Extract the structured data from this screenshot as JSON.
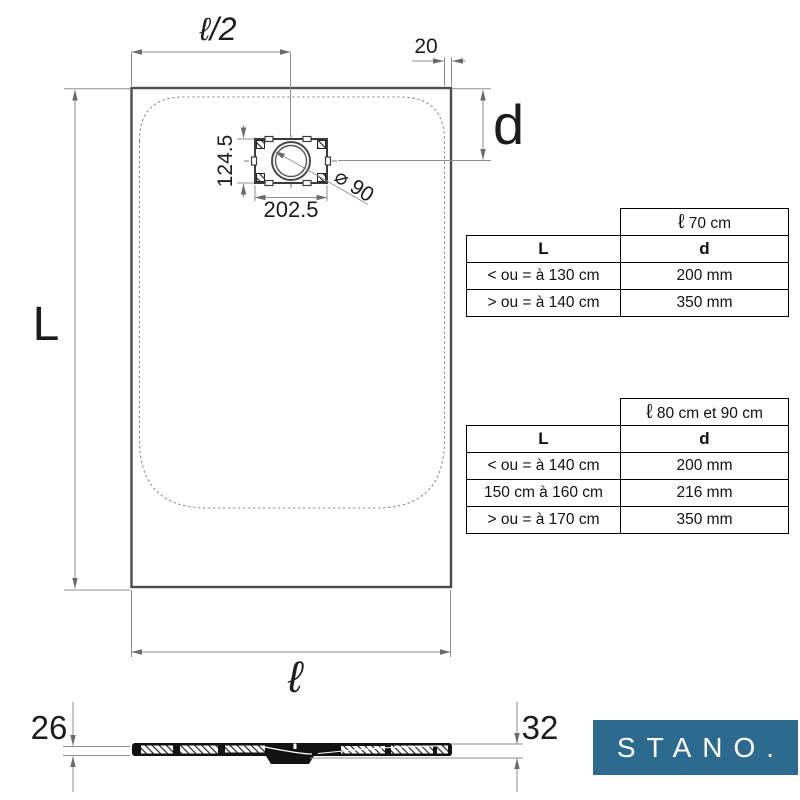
{
  "drawing": {
    "top_view": {
      "half_width_label": "ℓ/2",
      "edge_offset_label": "20",
      "drain_center_depth_label": "d",
      "length_label": "L",
      "drain_box_height_label": "124.5",
      "drain_box_width_label": "202.5",
      "drain_diameter_label": "⌀ 90",
      "width_label": "ℓ"
    },
    "side_view": {
      "thickness_left_label": "26",
      "thickness_right_label": "32"
    }
  },
  "tables": [
    {
      "width_symbol": "ℓ",
      "width_text": "70 cm",
      "col_headers": [
        "L",
        "d"
      ],
      "rows": [
        [
          "< ou = à 130 cm",
          "200 mm"
        ],
        [
          "> ou = à 140 cm",
          "350 mm"
        ]
      ]
    },
    {
      "width_symbol": "ℓ",
      "width_text": "80 cm et 90 cm",
      "col_headers": [
        "L",
        "d"
      ],
      "rows": [
        [
          "< ou = à 140 cm",
          "200 mm"
        ],
        [
          "150 cm à 160 cm",
          "216 mm"
        ],
        [
          "> ou = à 170 cm",
          "350 mm"
        ]
      ]
    }
  ],
  "logo": {
    "text": "STANO.",
    "background_color": "#2e6a8e",
    "text_color": "#ffffff"
  }
}
